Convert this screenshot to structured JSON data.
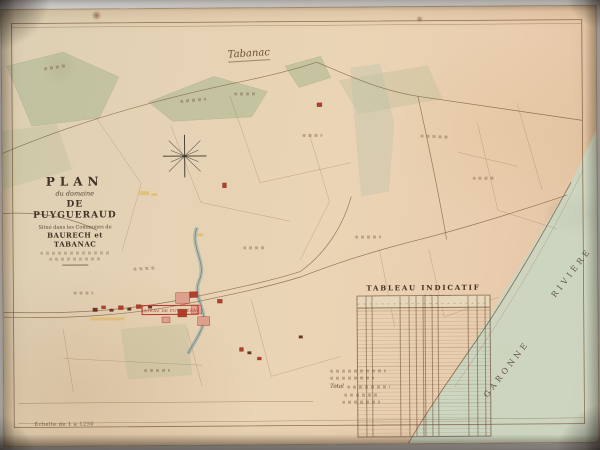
{
  "title_block": {
    "line1": "PLAN",
    "line2": "du domaine",
    "line3": "DE PUYGUERAUD",
    "line4": "Situé dans les Communes de",
    "line5": "BAURECH et TABANAC"
  },
  "labels": {
    "commune": "Tabanac",
    "chateau_box": "CHATEAU DE PUYGUERAUD",
    "river_name": "GARONNE",
    "river_word": "RIVIÈRE",
    "scale_note": "Échelle de 1 à 1250"
  },
  "table": {
    "title": "TABLEAU INDICATIF",
    "total_label": "Total"
  },
  "colors": {
    "green_wash": "#a3b48d",
    "river_wash": "#c8d7c4",
    "building_pink": "#dba08e",
    "building_red": "#b0402c",
    "ink_brown": "#7d5f41",
    "ink_red": "#b5342a",
    "road_yellow": "#ddb657"
  }
}
